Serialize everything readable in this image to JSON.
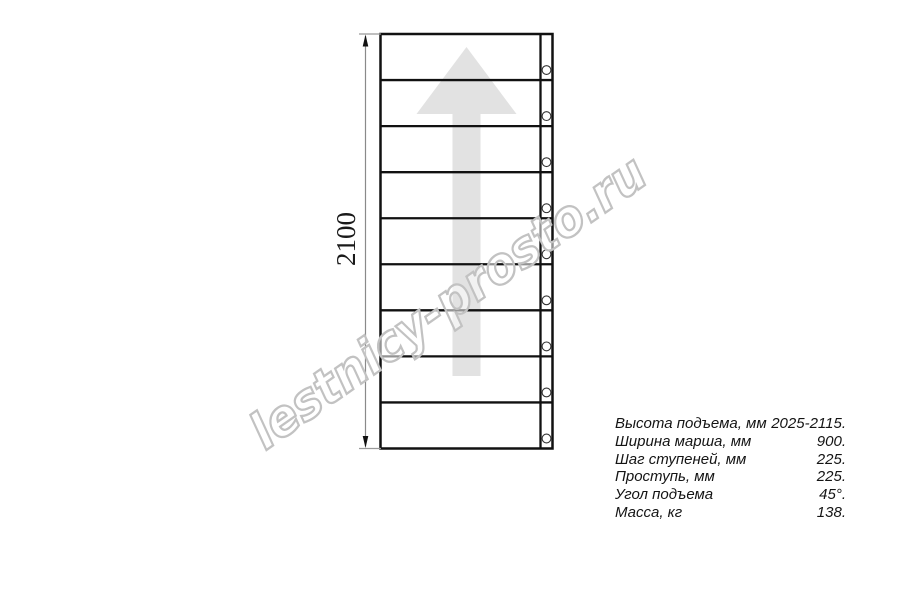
{
  "diagram": {
    "type": "stair-flight-plan-view",
    "dimension": {
      "label": "2100"
    },
    "steps_count": 9,
    "holes_count": 9,
    "direction_arrow": "up",
    "colors": {
      "line": "#111111",
      "arrow_fill": "#e2e2e2",
      "dim_line": "#8a8a8a",
      "ext_line": "#999999",
      "dim_text": "#1a1a1a",
      "hole_stroke": "#333333"
    }
  },
  "watermark": {
    "text": "lestnicy-prosto.ru",
    "color": "#c2c2c2"
  },
  "specs": {
    "rows": [
      {
        "label": "Высота подъема, мм",
        "value": "2025-2115."
      },
      {
        "label": "Ширина марша, мм",
        "value": "900."
      },
      {
        "label": "Шаг ступеней, мм",
        "value": "225."
      },
      {
        "label": "Проступь, мм",
        "value": "225."
      },
      {
        "label": "Угол подъема",
        "value": "45°."
      },
      {
        "label": "Масса, кг",
        "value": "138."
      }
    ]
  }
}
